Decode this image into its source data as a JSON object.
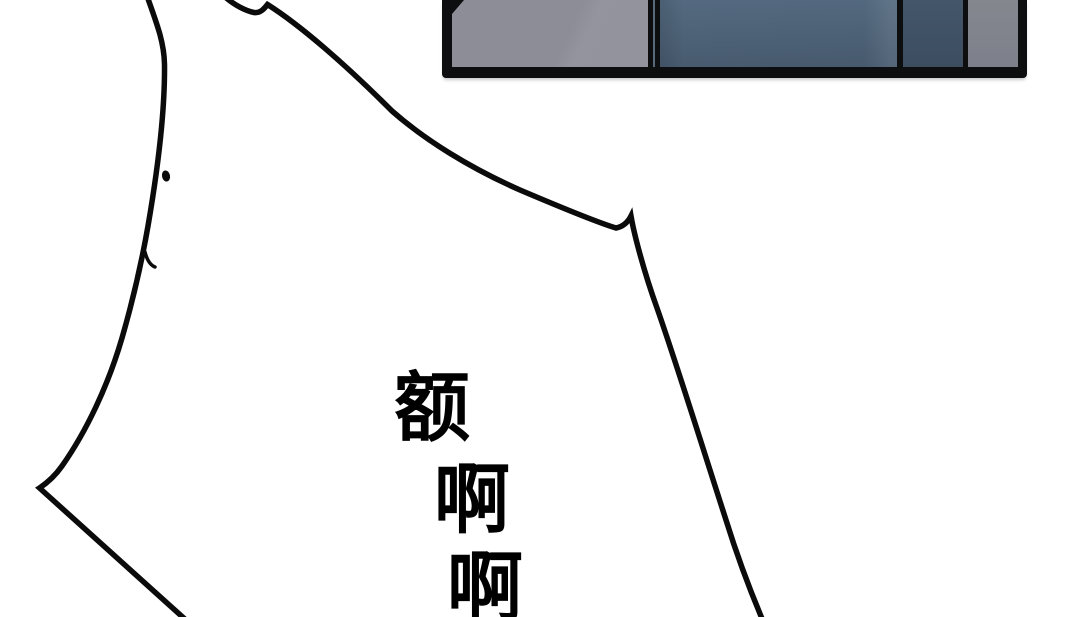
{
  "sound_effects": {
    "chars": [
      {
        "text": "额"
      },
      {
        "text": "啊"
      },
      {
        "text": "啊"
      }
    ]
  },
  "colors": {
    "background": "#ffffff",
    "outline": "#0b0b0b",
    "text": "#000000",
    "frame": "#0d0e10",
    "panel-gray-left": "#8c8d97",
    "panel-blue-top": "#546a80",
    "panel-blue": "#4d6176",
    "panel-blue-dark": "#46596d",
    "panel-navy-top": "#44566a",
    "panel-navy": "#3c4d60",
    "panel-gray-right-top": "#85878f",
    "panel-gray-right": "#7d808a",
    "divider-slit": "#57697b",
    "under-shadow": "#c7c9ce"
  }
}
